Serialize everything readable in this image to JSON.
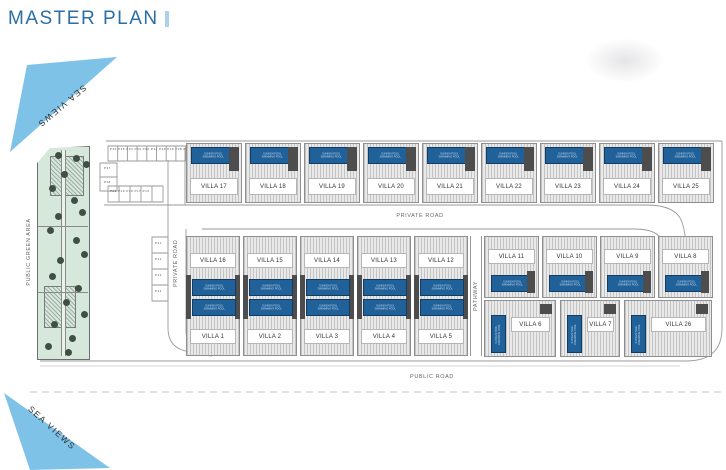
{
  "title": "MASTER PLAN",
  "sea_views_top": "SEA VIEWS",
  "sea_views_bottom": "SEA VIEWS",
  "labels": {
    "public_green_area": "PUBLIC GREEN AREA",
    "private_road_vertical": "PRIVATE ROAD",
    "private_road_horizontal": "PRIVATE ROAD",
    "pathway": "PATHWAY",
    "public_road": "PUBLIC ROAD"
  },
  "pool": {
    "line1": "SUNKEN POOL",
    "line2": "SWIMMING POOL"
  },
  "villas": {
    "top_row": [
      "VILLA 17",
      "VILLA 18",
      "VILLA 19",
      "VILLA 20",
      "VILLA 21",
      "VILLA 22",
      "VILLA 23",
      "VILLA 24",
      "VILLA 25"
    ],
    "middle_top_left": [
      "VILLA 16",
      "VILLA 15",
      "VILLA 14",
      "VILLA 13",
      "VILLA 12"
    ],
    "middle_bottom_left": [
      "VILLA 1",
      "VILLA 2",
      "VILLA 3",
      "VILLA 4",
      "VILLA 5"
    ],
    "middle_top_right": [
      "VILLA 11",
      "VILLA 10",
      "VILLA 9",
      "VILLA 8"
    ],
    "middle_bottom_right": [
      "VILLA 6",
      "VILLA 7",
      "VILLA 26"
    ]
  },
  "parking": {
    "top_row": "P36 P35 P34 P33 P32 P31 P30 P29 P28 P27",
    "left_stack": [
      "P37",
      "P38"
    ],
    "mid_row": "P20 P19 P18 P17 P16",
    "side_stack": [
      "P41",
      "P42",
      "P43",
      "P44"
    ]
  },
  "colors": {
    "accent_blue": "#2b6da5",
    "sea_view_blue": "#7fc2e8",
    "pool_blue": "#21619a",
    "green_area": "#d6e7dc"
  }
}
